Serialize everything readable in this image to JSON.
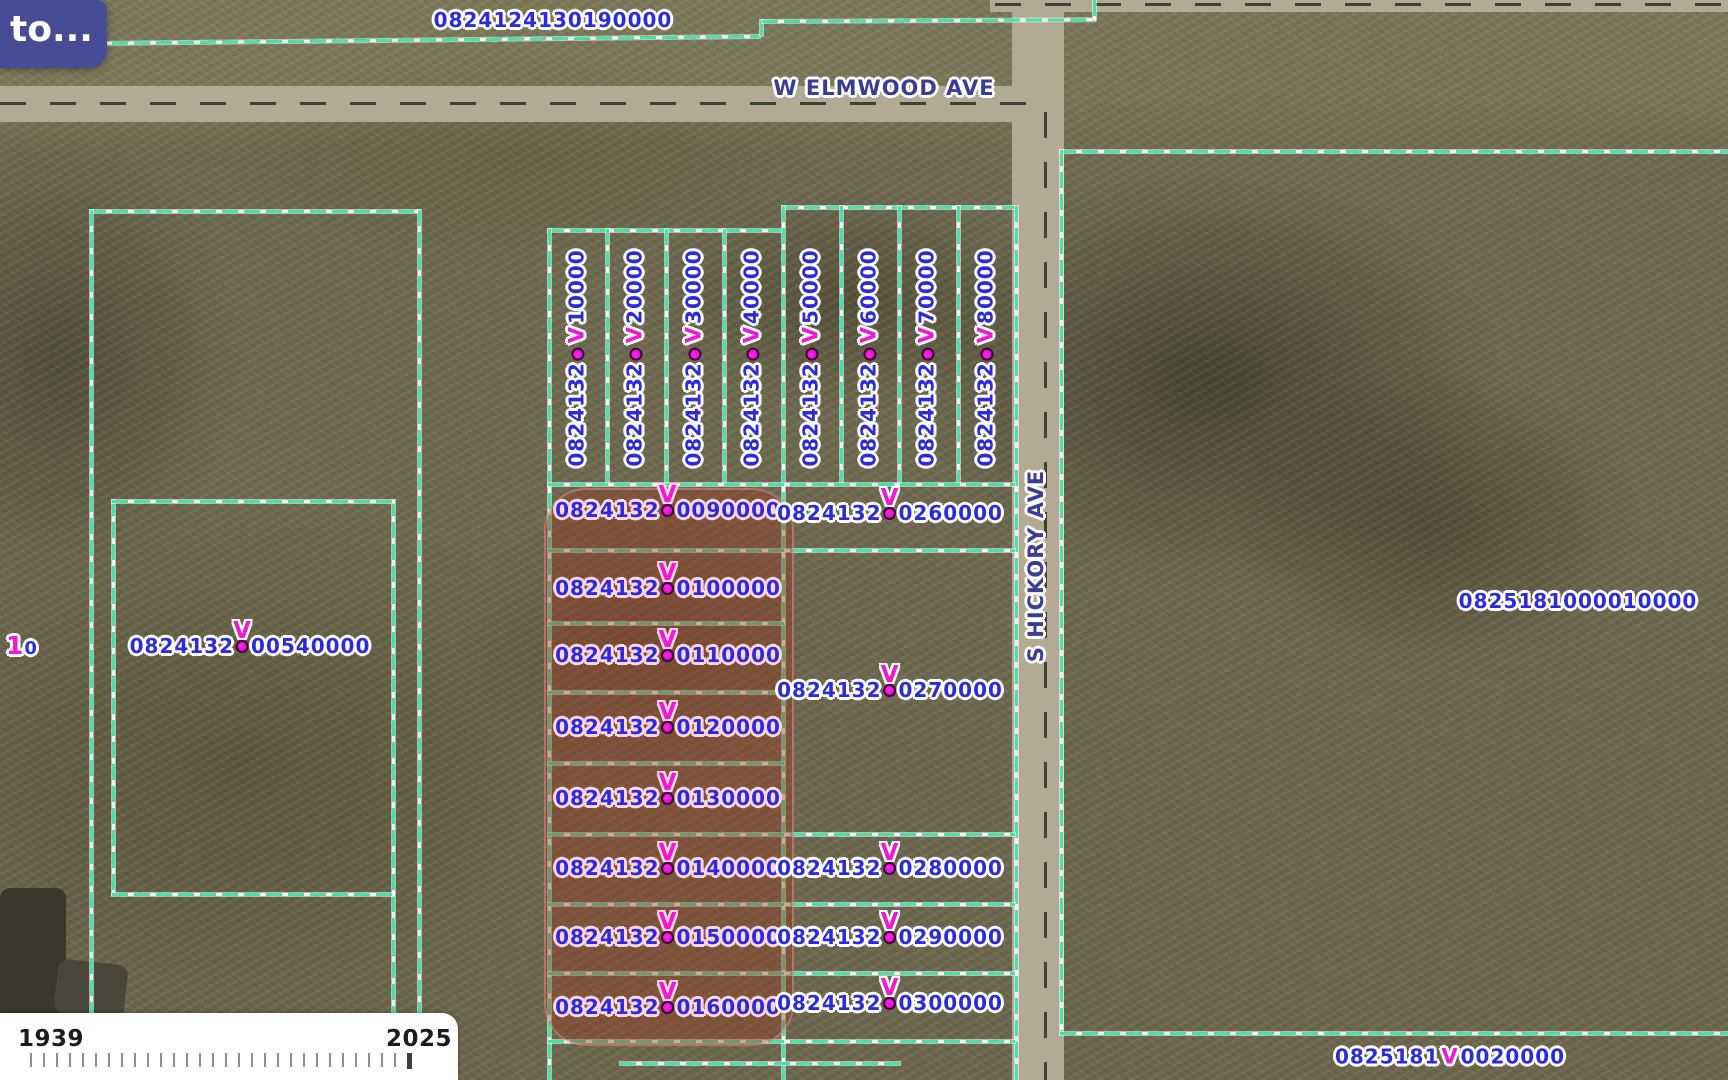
{
  "tooltip": {
    "label": "to..."
  },
  "streets": {
    "elmwood": "W ELMWOOD AVE",
    "hickory": "S HICKORY AVE"
  },
  "marker_glyph": "V",
  "labels": {
    "top_parcel": "0824124130190000",
    "right_parcel": "0825181000010000",
    "left_parcel": {
      "prefix": "0824132",
      "suffix": "00540000"
    },
    "left_edge_partial": {
      "first": "1",
      "second": "0"
    },
    "bottom_right": {
      "prefix": "0825181",
      "suffix": "0020000"
    }
  },
  "vertical_lots": [
    {
      "prefix": "0824132",
      "suffix": "10000",
      "x": 577
    },
    {
      "prefix": "0824132",
      "suffix": "20000",
      "x": 635
    },
    {
      "prefix": "0824132",
      "suffix": "30000",
      "x": 694
    },
    {
      "prefix": "0824132",
      "suffix": "40000",
      "x": 752
    },
    {
      "prefix": "0824132",
      "suffix": "50000",
      "x": 811
    },
    {
      "prefix": "0824132",
      "suffix": "60000",
      "x": 869
    },
    {
      "prefix": "0824132",
      "suffix": "70000",
      "x": 927
    },
    {
      "prefix": "0824132",
      "suffix": "80000",
      "x": 986
    }
  ],
  "highlighted_rows": [
    {
      "prefix": "0824132",
      "suffix": "0090000",
      "y": 510
    },
    {
      "prefix": "0824132",
      "suffix": "0100000",
      "y": 588
    },
    {
      "prefix": "0824132",
      "suffix": "0110000",
      "y": 655
    },
    {
      "prefix": "0824132",
      "suffix": "0120000",
      "y": 727
    },
    {
      "prefix": "0824132",
      "suffix": "0130000",
      "y": 798
    },
    {
      "prefix": "0824132",
      "suffix": "0140000",
      "y": 868
    },
    {
      "prefix": "0824132",
      "suffix": "0150000",
      "y": 937
    },
    {
      "prefix": "0824132",
      "suffix": "0160000",
      "y": 1007
    }
  ],
  "right_rows": [
    {
      "prefix": "0824132",
      "suffix": "0260000",
      "y": 513
    },
    {
      "prefix": "0824132",
      "suffix": "0270000",
      "y": 690
    },
    {
      "prefix": "0824132",
      "suffix": "0280000",
      "y": 868
    },
    {
      "prefix": "0824132",
      "suffix": "0290000",
      "y": 937
    },
    {
      "prefix": "0824132",
      "suffix": "0300000",
      "y": 1003
    }
  ],
  "timeline": {
    "start_year": "1939",
    "end_year": "2025",
    "tick_count": 30
  },
  "colors": {
    "boundary": "#49e2a6",
    "parcel_text": "#2b2bdb",
    "street_text": "#3a3d95",
    "marker": "#f316d4",
    "highlight": "rgba(150,58,34,0.42)",
    "tooltip_bg": "#474c96"
  }
}
